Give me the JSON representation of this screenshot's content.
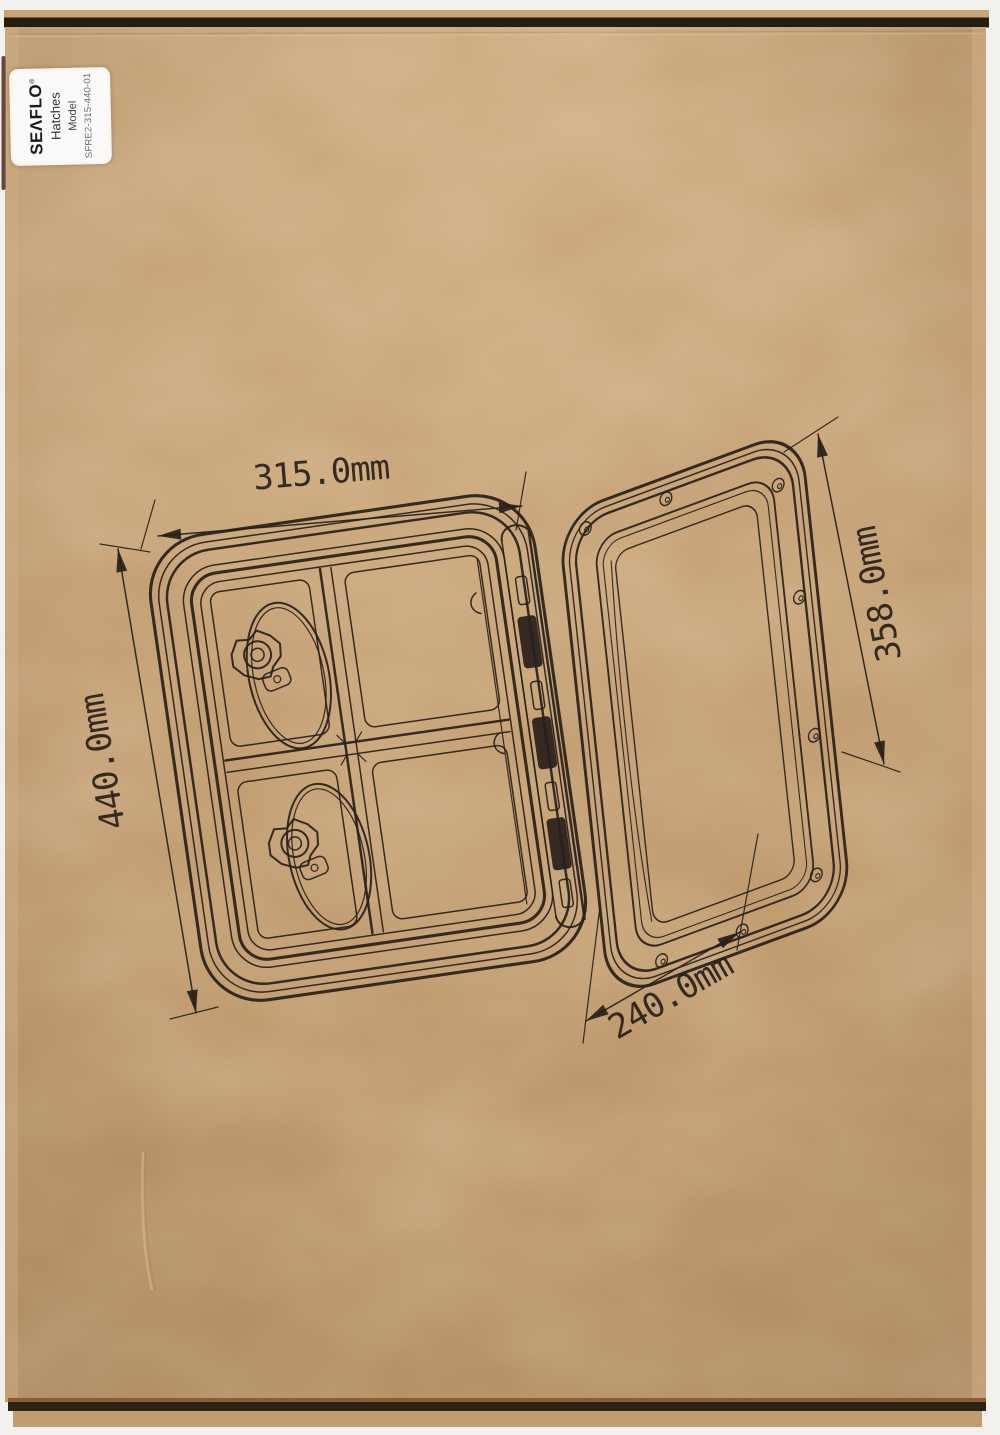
{
  "label": {
    "brand": "SEΛFLO",
    "registered": "®",
    "product_type": "Hatches",
    "model_caption": "Model",
    "model_number": "SFRE2-315-440-01",
    "bg_color": "#fbfaf8"
  },
  "diagram": {
    "subject": "boat access hatch with open lid, line drawing",
    "dimensions": {
      "frame_width": "315.0mm",
      "frame_height": "440.0mm",
      "lid_length": "358.0mm",
      "lid_width": "240.0mm"
    },
    "ink_color": "#27201a"
  },
  "box": {
    "cardboard_color": "#c7a173",
    "top_edge_color": "#241d10",
    "bottom_edge_color": "#2a2315",
    "background_color": "#f3f1ee"
  }
}
